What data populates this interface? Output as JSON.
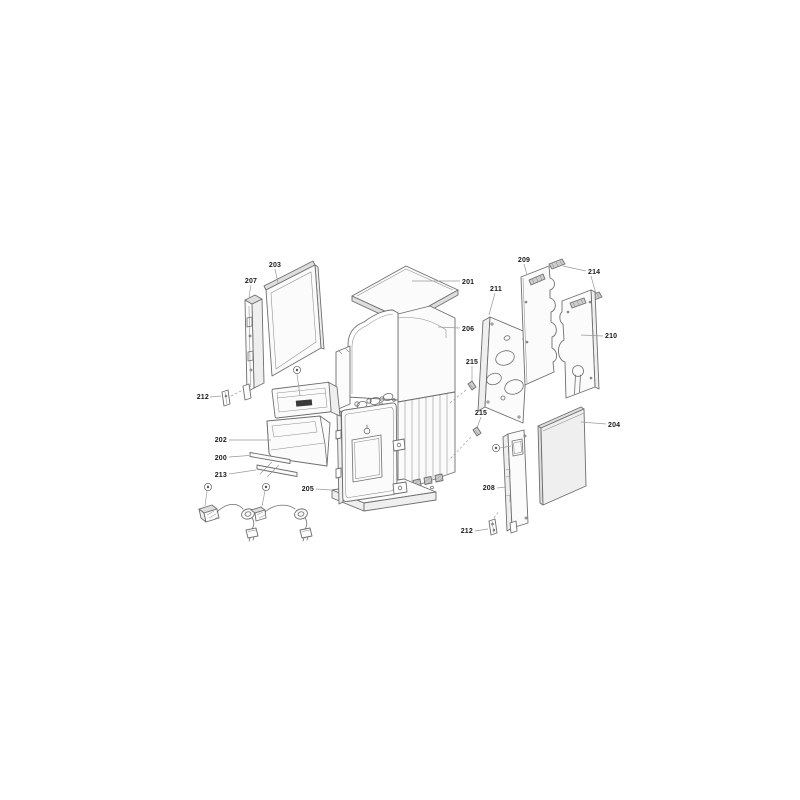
{
  "page": {
    "background_color": "#ffffff"
  },
  "diagram": {
    "type": "exploded-parts-diagram",
    "labels": {
      "p200": "200",
      "p201": "201",
      "p202": "202",
      "p203": "203",
      "p204": "204",
      "p205": "205",
      "p206": "206",
      "p207": "207",
      "p208": "208",
      "p209": "209",
      "p210": "210",
      "p211": "211",
      "p212_left": "212",
      "p212_right": "212",
      "p213": "213",
      "p214": "214",
      "p215_upper": "215",
      "p215_lower": "215"
    },
    "style": {
      "outline_color": "#6e6e6e",
      "label_color": "#1b1b1b",
      "leader_color": "#9a9a9a",
      "panel_fill": "#fbfbfb",
      "shade_fill": "#e3e3e3",
      "hatch_fill": "#cdcdcd"
    },
    "icons": {
      "fastener_callout": "circled-dot"
    }
  }
}
